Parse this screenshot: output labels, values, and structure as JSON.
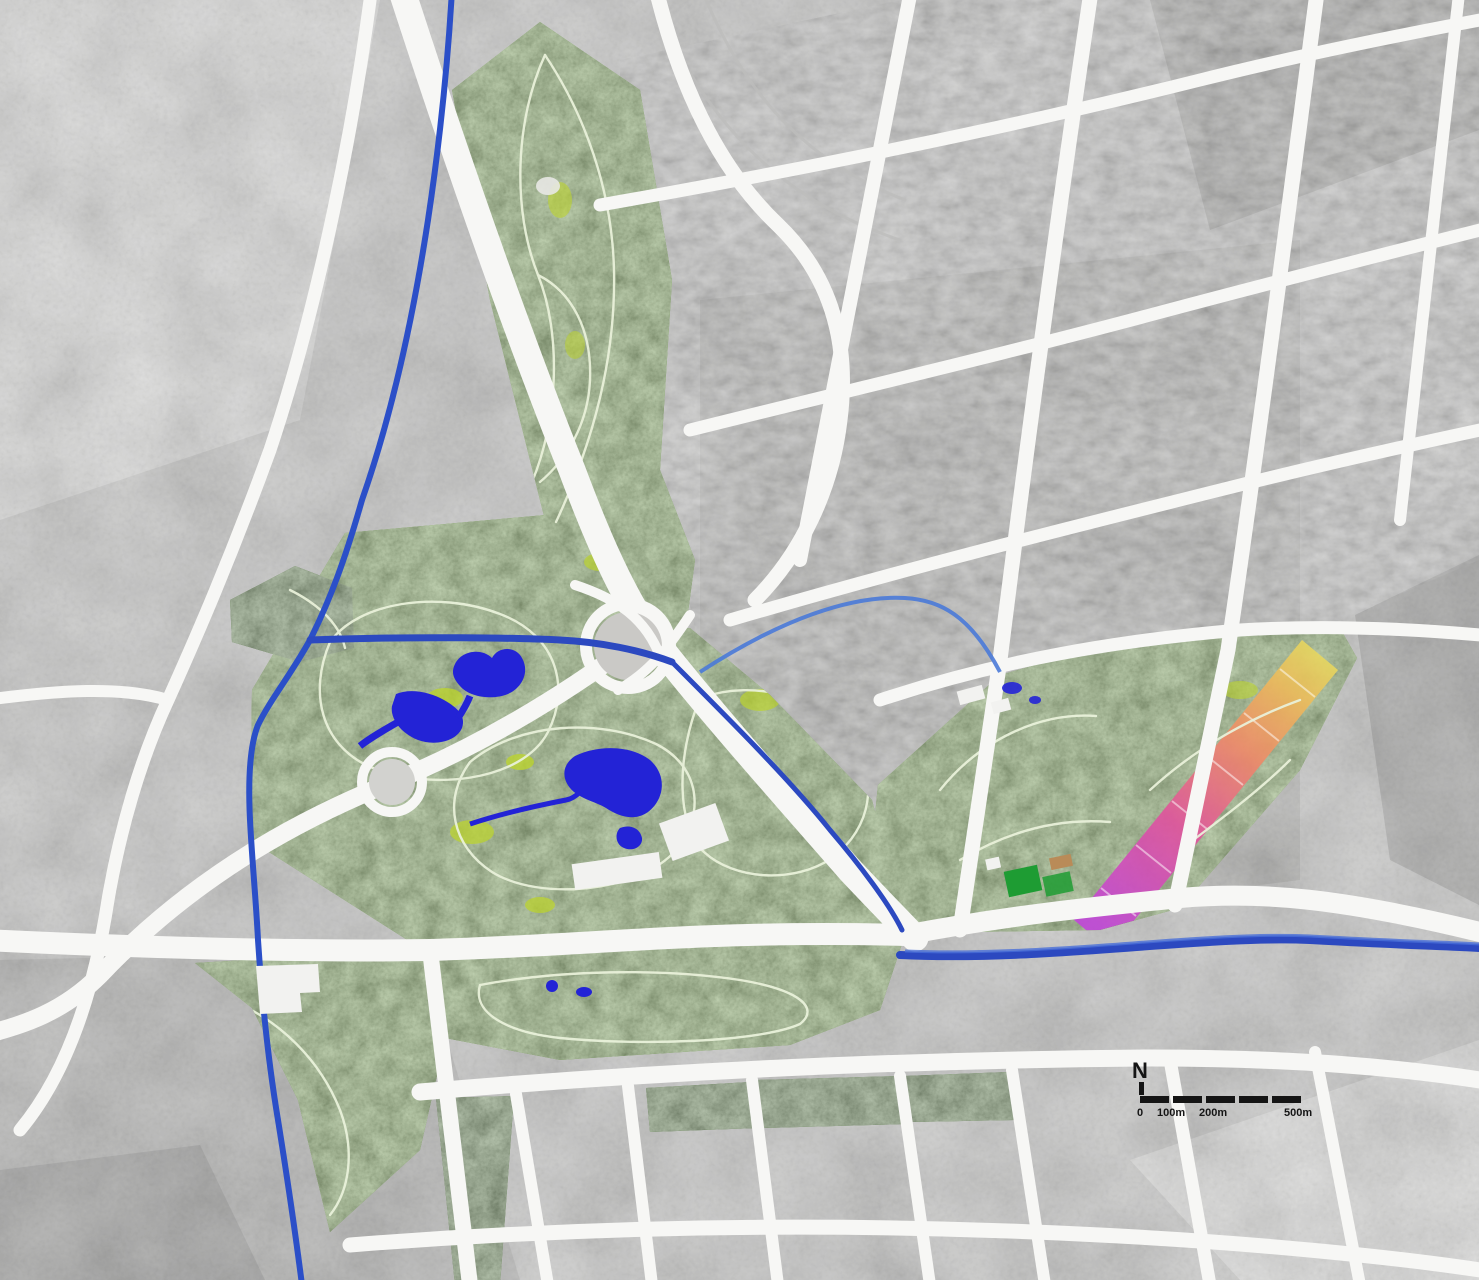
{
  "map": {
    "type": "landscape-masterplan-over-grayscale-aerial",
    "legend": {
      "north_label": "N",
      "scale_ticks": [
        "0",
        "100m",
        "200m",
        "500m"
      ]
    },
    "colors": {
      "aerial": "#d0d0cf",
      "aerial_light": "#e7e7e6",
      "aerial_dark": "#9a9a99",
      "road": "#f7f7f5",
      "rail": "#bdbdbc",
      "park": "#55941e",
      "park_dark": "#2e6210",
      "park_light": "#bcd32f",
      "path": "#e9f1da",
      "lake": "#2323d6",
      "river": "#2b4fc8",
      "canal": "#2c49c0",
      "corridor_magenta": "#c148d8",
      "corridor_pink": "#e0559d",
      "corridor_orange": "#ee8a6a",
      "corridor_amber": "#ecb95c",
      "corridor_yellow": "#e4e062",
      "field": "#1e9c33",
      "court": "#b98b58",
      "building": "#f2f2f0",
      "text": "#151515"
    },
    "features": [
      "north-park-strip",
      "central-park",
      "south-park-lobe",
      "southwest-park-band",
      "southwest-woodland-blocks",
      "east-park",
      "flower-corridor",
      "heart-lake",
      "west-lake",
      "central-lake",
      "main-river",
      "park-canal",
      "east-canal",
      "highway",
      "ring-boulevard",
      "interchange",
      "roundabout-plaza",
      "sports-fields",
      "exhibition-buildings",
      "street-green-strips"
    ]
  }
}
